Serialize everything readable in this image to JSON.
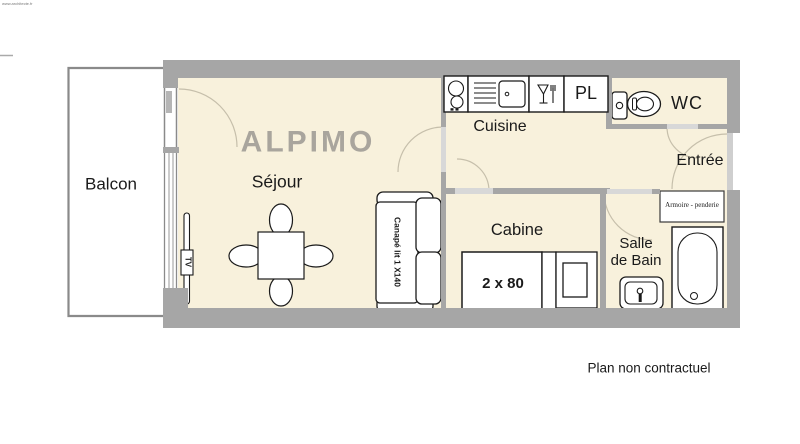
{
  "watermark": "www.architecte.fr",
  "plan": {
    "title": "ALPIMO",
    "disclaimer": "Plan non contractuel"
  },
  "rooms": {
    "balcon": {
      "label": "Balcon"
    },
    "sejour": {
      "label": "Séjour"
    },
    "cuisine": {
      "label": "Cuisine"
    },
    "placard": {
      "label": "PL"
    },
    "wc": {
      "label": "WC"
    },
    "entree": {
      "label": "Entrée"
    },
    "cabine": {
      "label": "Cabine"
    },
    "salle_de_bain": {
      "label_line1": "Salle",
      "label_line2": "de Bain"
    }
  },
  "furniture": {
    "bed": {
      "label": "2 x 80"
    },
    "sofa": {
      "label": "Canapé lit 1 X140"
    },
    "tv": {
      "label": "TV"
    },
    "armoire": {
      "label": "Armoire - penderie"
    }
  },
  "colors": {
    "wall": "#a6a6a6",
    "door_gap": "#d8d8d8",
    "floor": "#f8f1dc",
    "title_text": "#a9a59d",
    "balcony_border": "#8a8a8a"
  }
}
